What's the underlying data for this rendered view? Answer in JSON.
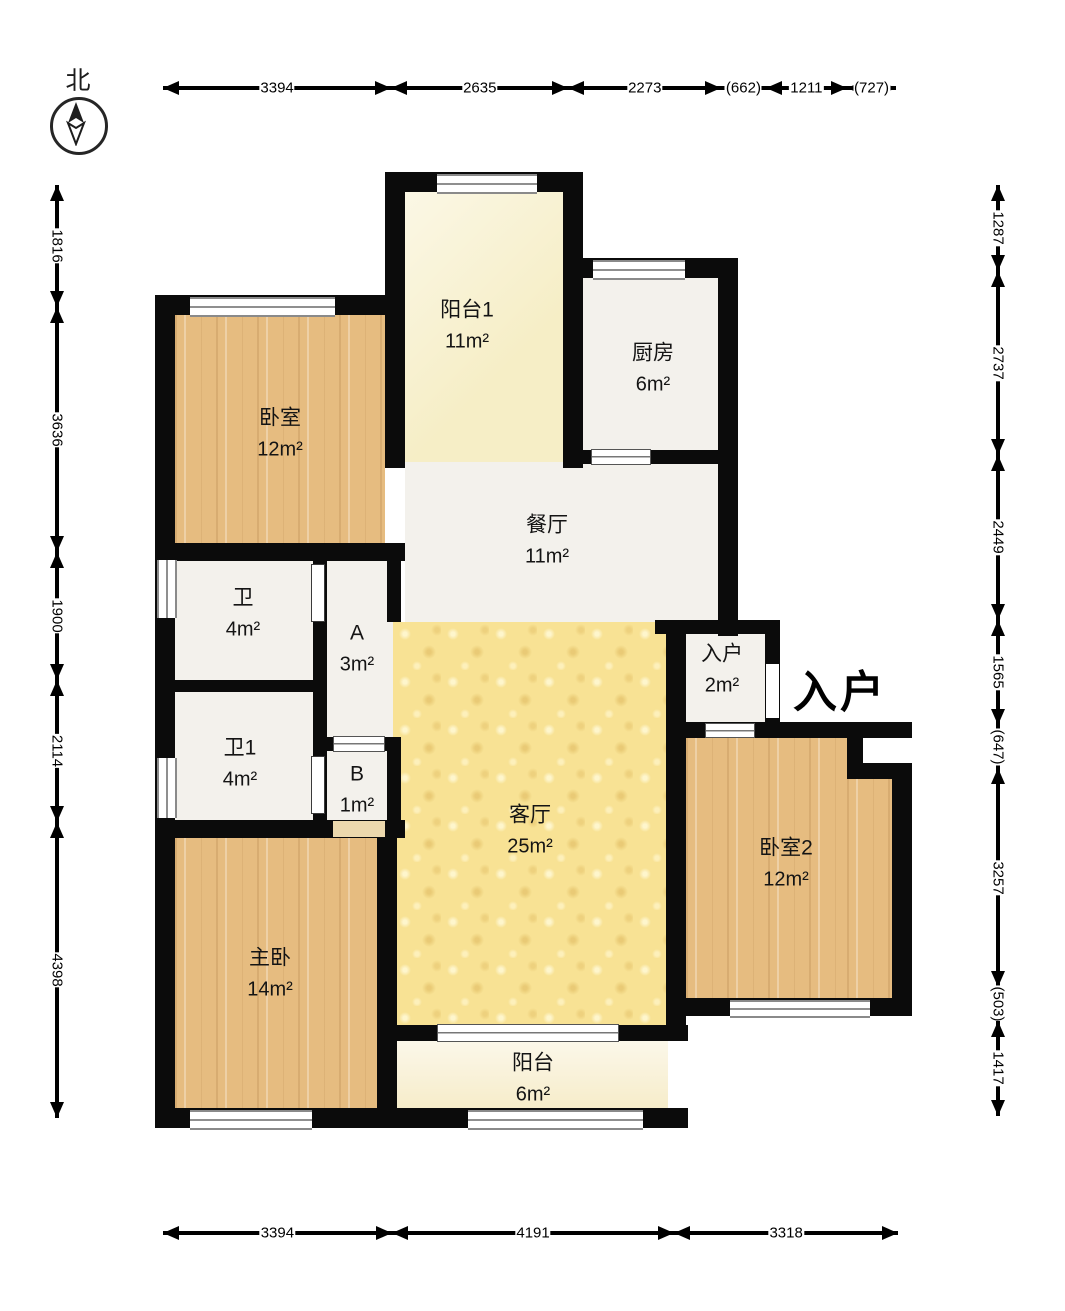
{
  "compass": {
    "label": "北"
  },
  "entry_label": "入户",
  "rooms": [
    {
      "id": "bedroom1",
      "name": "卧室",
      "area": "12m²",
      "cx": 280,
      "cy": 433
    },
    {
      "id": "balcony1",
      "name": "阳台1",
      "area": "11m²",
      "cx": 467,
      "cy": 325
    },
    {
      "id": "kitchen",
      "name": "厨房",
      "area": "6m²",
      "cx": 653,
      "cy": 368
    },
    {
      "id": "dining",
      "name": "餐厅",
      "area": "11m²",
      "cx": 547,
      "cy": 540
    },
    {
      "id": "bath",
      "name": "卫",
      "area": "4m²",
      "cx": 243,
      "cy": 613
    },
    {
      "id": "hall-a",
      "name": "A",
      "area": "3m²",
      "cx": 357,
      "cy": 648
    },
    {
      "id": "bath1",
      "name": "卫1",
      "area": "4m²",
      "cx": 240,
      "cy": 763
    },
    {
      "id": "hall-b",
      "name": "B",
      "area": "1m²",
      "cx": 357,
      "cy": 789
    },
    {
      "id": "living",
      "name": "客厅",
      "area": "25m²",
      "cx": 530,
      "cy": 830
    },
    {
      "id": "entry",
      "name": "入户",
      "area": "2m²",
      "cx": 722,
      "cy": 669
    },
    {
      "id": "bedroom2",
      "name": "卧室2",
      "area": "12m²",
      "cx": 786,
      "cy": 863
    },
    {
      "id": "master",
      "name": "主卧",
      "area": "14m²",
      "cx": 270,
      "cy": 973
    },
    {
      "id": "balcony2",
      "name": "阳台",
      "area": "6m²",
      "cx": 533,
      "cy": 1078
    }
  ],
  "dimensions": {
    "top": {
      "labels": [
        "3394",
        "2635",
        "2273",
        "(662)",
        "1211",
        "(727)"
      ],
      "values": [
        3394,
        2635,
        2273,
        662,
        1211,
        727
      ]
    },
    "bottom": {
      "labels": [
        "3394",
        "4191",
        "3318"
      ],
      "values": [
        3394,
        4191,
        3318
      ]
    },
    "left": {
      "labels": [
        "1816",
        "3636",
        "1900",
        "2114",
        "4398"
      ],
      "values": [
        1816,
        3636,
        1900,
        2114,
        4398
      ]
    },
    "right": {
      "labels": [
        "1287",
        "2737",
        "2449",
        "1565",
        "(647)",
        "3257",
        "(503)",
        "1417"
      ],
      "values": [
        1287,
        2737,
        2449,
        1565,
        647,
        3257,
        503,
        1417
      ]
    }
  }
}
